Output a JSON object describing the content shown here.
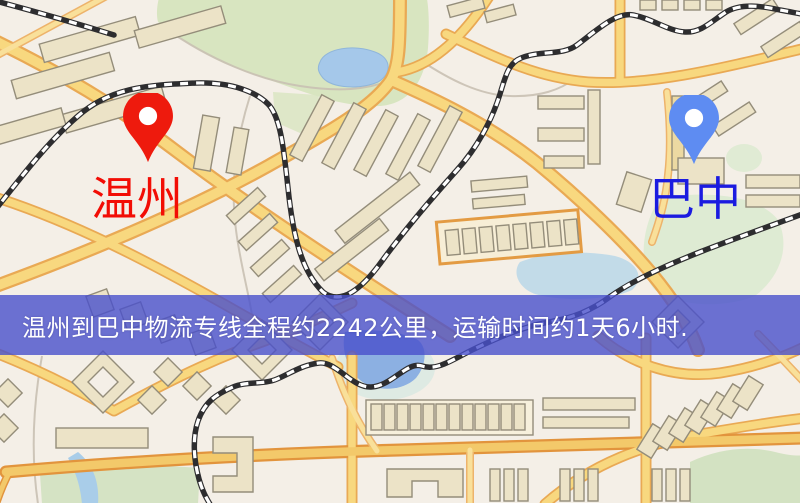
{
  "banner": {
    "text": "温州到巴中物流专线全程约2242公里，运输时间约1天6小时.",
    "bg_color": "#4950cc",
    "text_color": "#ffffff"
  },
  "route": {
    "origin": "温州",
    "destination": "巴中",
    "distance_km": "2242",
    "duration": "1天6小时"
  },
  "markers": {
    "origin": {
      "name": "温州",
      "pin_color": "#ee1a0d",
      "label_color": "#f20d05"
    },
    "destination": {
      "name": "巴中",
      "pin_color": "#5e8cf2",
      "label_color": "#1b1be0"
    }
  },
  "map": {
    "palette": {
      "background": "#f4efe7",
      "park_green": "#d8e5c0",
      "water_blue": "#a5c8ea",
      "road_fill": "#f8d87f",
      "road_casing": "#e9a954",
      "building_fill": "#ece3c7",
      "building_stroke": "#948d7a",
      "railway_dark": "#2d2d2f",
      "railway_light": "#ffffff"
    }
  }
}
